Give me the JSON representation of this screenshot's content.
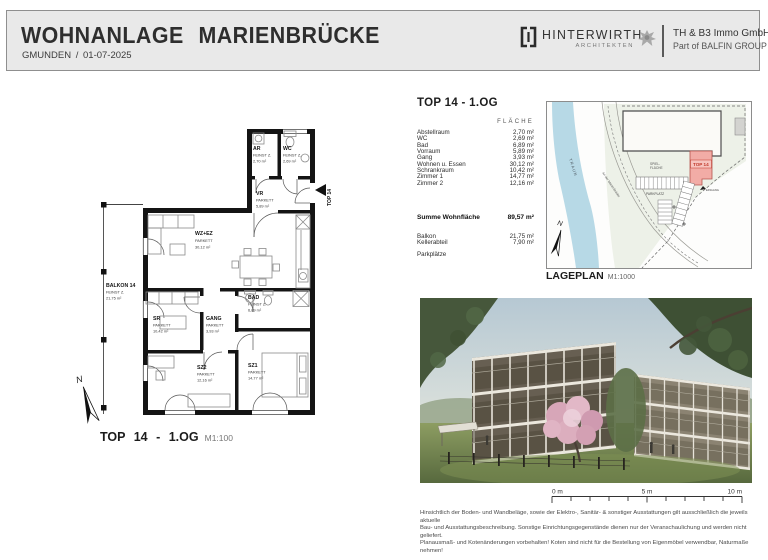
{
  "header": {
    "title": "WOHNANLAGE MARIENBRÜCKE",
    "subtitle": "GMUNDEN / 01-07-2025",
    "architect": {
      "name": "HINTERWIRTH",
      "sub": "ARCHITEKTEN"
    },
    "company": {
      "line1": "TH & B3 Immo GmbH",
      "line2": "Part of BALFIN GROUP"
    }
  },
  "unit": {
    "heading": "TOP 14 - 1.OG",
    "column_header": "FLÄCHE",
    "rows": [
      {
        "label": "Abstellraum",
        "value": "2,70 m²"
      },
      {
        "label": "WC",
        "value": "2,69 m²"
      },
      {
        "label": "Bad",
        "value": "6,89 m²"
      },
      {
        "label": "Vorraum",
        "value": "5,89 m²"
      },
      {
        "label": "Gang",
        "value": "3,93 m²"
      },
      {
        "label": "Wohnen u. Essen",
        "value": "30,12 m²"
      },
      {
        "label": "Schrankraum",
        "value": "10,42 m²"
      },
      {
        "label": "Zimmer 1",
        "value": "14,77 m²"
      },
      {
        "label": "Zimmer 2",
        "value": "12,16 m²"
      }
    ],
    "sum": {
      "label": "Summe Wohnfläche",
      "value": "89,57 m²"
    },
    "extras": [
      {
        "label": "Balkon",
        "value": "21,75 m²"
      },
      {
        "label": "Kellerabteil",
        "value": "7,90 m²"
      },
      {
        "label": "Parkplätze",
        "value": ""
      }
    ]
  },
  "floorplan": {
    "caption": "TOP 14 - 1.OG",
    "scale": "M1:100",
    "north": "N",
    "entry": "TOP 14",
    "rooms": [
      {
        "name": "AR",
        "finish": "FEINST Z.",
        "area": "2,70 m²"
      },
      {
        "name": "WC",
        "finish": "FEINST Z.",
        "area": "2,69 m²"
      },
      {
        "name": "VR",
        "finish": "PARKETT",
        "area": "5,89 m²"
      },
      {
        "name": "WZ+EZ",
        "finish": "PARKETT",
        "area": "30,12 m²"
      },
      {
        "name": "BALKON 14",
        "finish": "FEINST Z.",
        "area": "21,75 m²"
      },
      {
        "name": "SR",
        "finish": "PARKETT",
        "area": "10,42 m²"
      },
      {
        "name": "GANG",
        "finish": "PARKETT",
        "area": "3,93 m²"
      },
      {
        "name": "BAD",
        "finish": "FEINST Z.",
        "area": "6,89 m²"
      },
      {
        "name": "SZ2",
        "finish": "PARKETT",
        "area": "12,16 m²"
      },
      {
        "name": "SZ1",
        "finish": "PARKETT",
        "area": "14,77 m²"
      }
    ]
  },
  "siteplan": {
    "caption": "LAGEPLAN",
    "scale": "M1:1000",
    "river": "TRAUN",
    "road": "An der Marienbrücke",
    "play_area_1": "SPIEL-",
    "play_area_2": "FLÄCHE",
    "parking": "PARKPLATZ",
    "unit": "TOP 14",
    "entrance": "EINGANG",
    "north": "N",
    "colors": {
      "unit_fill": "#f2aca6",
      "unit_text": "#c0392b",
      "river": "#b7d9e6"
    }
  },
  "scalebar": {
    "zero": "0 m",
    "five": "5 m",
    "ten": "10 m"
  },
  "disclaimer": {
    "line1": "Hinsichtlich der Boden- und Wandbeläge, sowie der Elektro-, Sanitär- & sonstiger Ausstattungen gilt ausschließlich die jeweils aktuelle",
    "line2": "Bau- und Ausstattungsbeschreibung. Sonstige Einrichtungsgegenstände dienen nur der Veranschaulichung und werden nicht geliefert.",
    "line3": "Planausmaß- und Kotenänderungen vorbehalten! Koten sind nicht für die Bestellung von Eigenmöbel verwendbar, Naturmaße nehmen!"
  }
}
